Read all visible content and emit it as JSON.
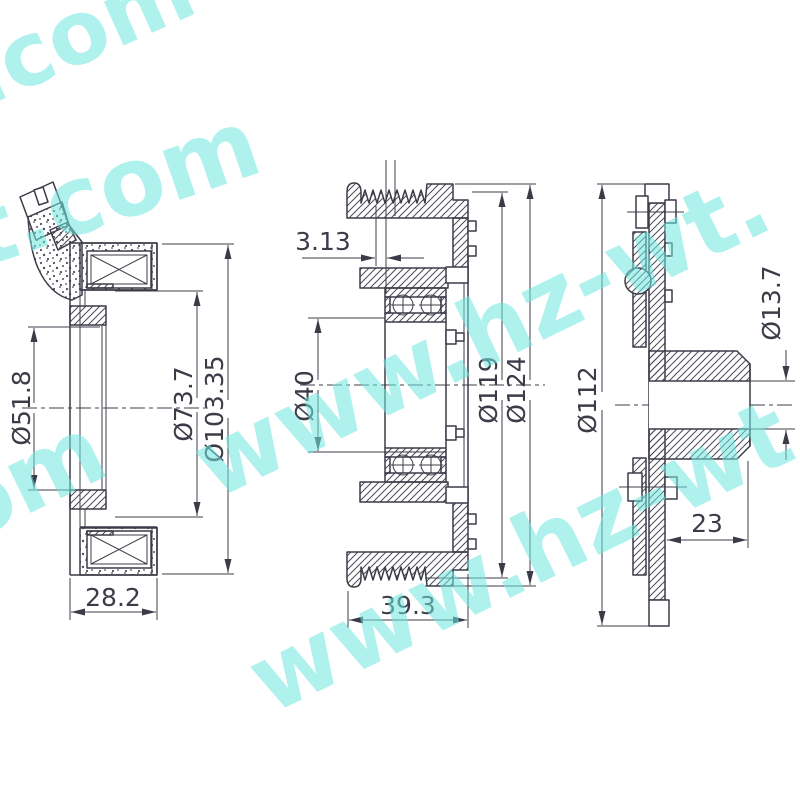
{
  "drawing": {
    "type": "technical-drawing",
    "subject": "clutch pulley assembly three-view section drawing",
    "colors": {
      "line": "#3c3c48",
      "watermark": "#6fe7df",
      "background": "#ffffff"
    },
    "watermark": {
      "text": "www.hz-wt.com",
      "fragments": [
        "t.com",
        "-wt.com",
        "om",
        "www.hz-wt.",
        "www.hz-wt."
      ]
    },
    "views": {
      "left": {
        "dims": {
          "bore": "Ø51.8",
          "coil": "Ø73.7",
          "outer": "Ø103.35",
          "width": "28.2"
        }
      },
      "middle": {
        "dims": {
          "pitch": "3.13",
          "bore": "Ø40",
          "groove": "Ø119",
          "outer": "Ø124",
          "width": "39.3"
        }
      },
      "right": {
        "dims": {
          "disc": "Ø112",
          "hole": "Ø13.7",
          "depth": "23"
        }
      }
    }
  }
}
